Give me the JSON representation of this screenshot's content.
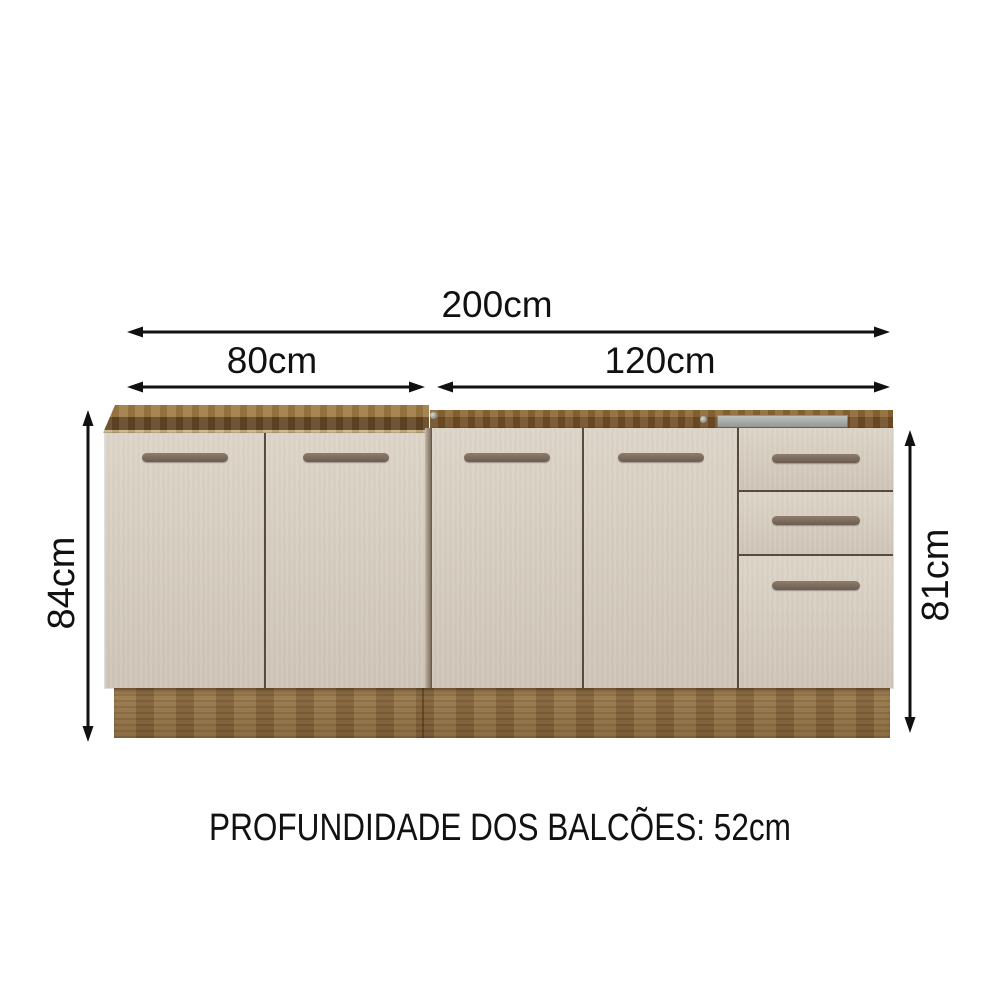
{
  "diagram": {
    "dimensions": {
      "total_width": "200cm",
      "left_section_width": "80cm",
      "right_section_width": "120cm",
      "left_section_height": "84cm",
      "right_section_height": "81cm"
    },
    "footer_note": "PROFUNDIDADE DOS BALCÕES: 52cm"
  },
  "colors": {
    "arrow": "#111111",
    "door_light": "#ded5c9",
    "door_dark": "#cfc5b9",
    "handle_light": "#8d7d6e",
    "handle_dark": "#6b5c4f",
    "top_surface": "#9c7a46",
    "top_front": "#5f4325",
    "top_edge_light": "#c7b488",
    "frame_top": "#8a6736",
    "frame_front": "#6e4d28",
    "base_light": "#97764a",
    "base_dark": "#7c5c33",
    "sink_light": "#c2c6c1",
    "sink_dark": "#8e938e",
    "gap": "#564b3e"
  }
}
